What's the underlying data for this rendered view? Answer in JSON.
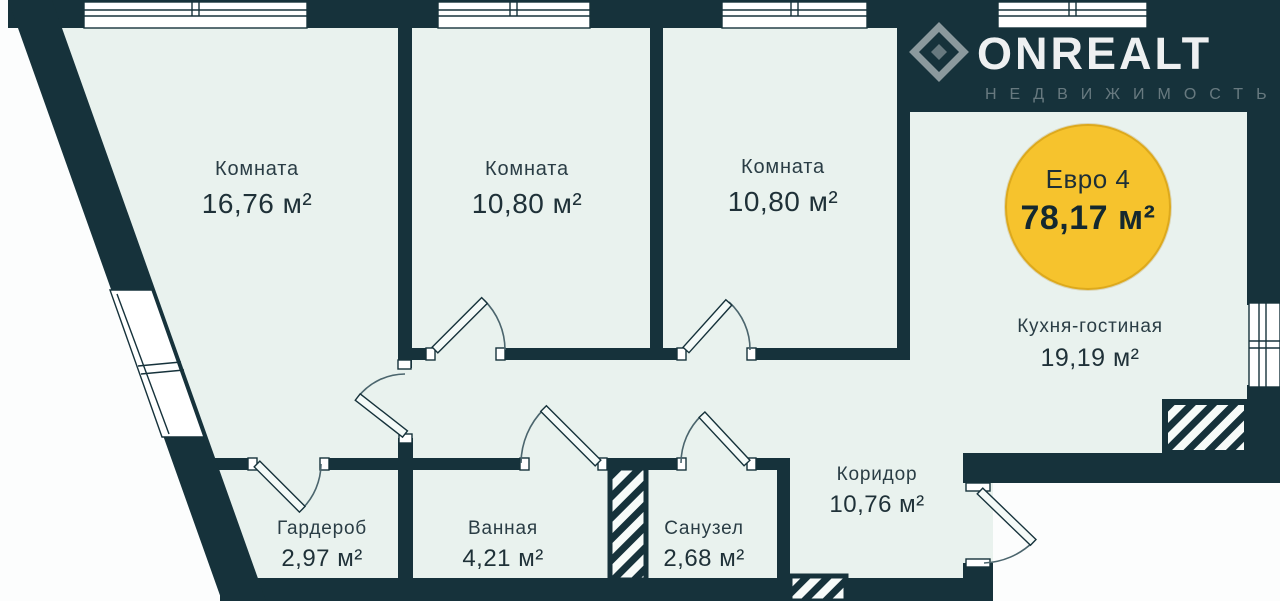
{
  "canvas": {
    "width": "1280",
    "height": "601"
  },
  "logo": {
    "brand": "ONREALT",
    "subtitle": "НЕДВИЖИМОСТЬ"
  },
  "badge": {
    "plan_type": "Евро 4",
    "total_area": "78,17 м²"
  },
  "rooms": [
    {
      "name": "Комната",
      "area": "16,76 м²"
    },
    {
      "name": "Комната",
      "area": "10,80 м²"
    },
    {
      "name": "Комната",
      "area": "10,80 м²"
    },
    {
      "name": "Кухня-гостиная",
      "area": "19,19 м²"
    },
    {
      "name": "Коридор",
      "area": "10,76 м²"
    },
    {
      "name": "Гардероб",
      "area": "2,97 м²"
    },
    {
      "name": "Ванная",
      "area": "4,21 м²"
    },
    {
      "name": "Санузел",
      "area": "2,68 м²"
    }
  ],
  "colors": {
    "wall": "#16323B",
    "interior": "#E9F2EE",
    "outside": "#FCFDFD",
    "badge_fill": "#F6C32D",
    "badge_border": "#DDA91C",
    "label_text": "#233640",
    "logo_white": "#FFFFFF"
  }
}
